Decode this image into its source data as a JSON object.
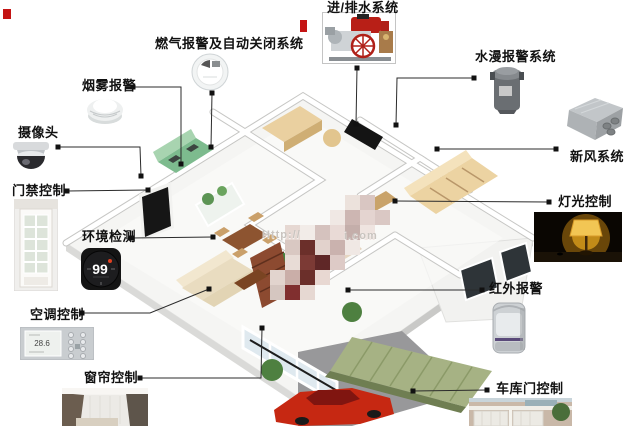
{
  "diagram_title": "",
  "labels": {
    "water_supply_drainage": "进/排水系统",
    "gas_alarm_shutoff": "燃气报警及自动关闭系统",
    "flood_alarm": "水漫报警系统",
    "smoke_alarm": "烟雾报警",
    "camera": "摄像头",
    "fresh_air": "新风系统",
    "door_access": "门禁控制",
    "lighting_control": "灯光控制",
    "environment_monitor": "环境检测",
    "infrared_alarm": "红外报警",
    "ac_control": "空调控制",
    "curtain_control": "窗帘控制",
    "garage_door": "车库门控制"
  },
  "readings": {
    "thermostat": "99",
    "ac_panel": "28.6"
  },
  "watermark": {
    "prefix": "Http://",
    "suffix": "i.com"
  },
  "colors": {
    "label_text": "#111111",
    "connector": "#2b2b2b",
    "car_red": "#c62812",
    "carport_green": "#a6b284",
    "kitchen_green": "#7dbb8e",
    "pump_red": "#b81f17",
    "watermark_gray": "#c9c4bf"
  }
}
